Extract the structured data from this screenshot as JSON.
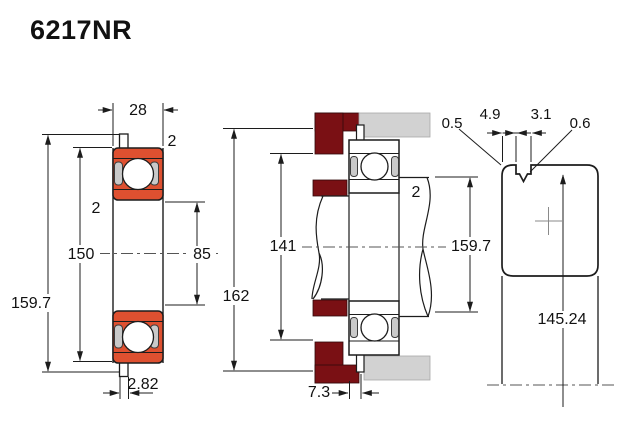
{
  "title": "6217NR",
  "front_view": {
    "width": "28",
    "outer_diameter": "150",
    "bore_diameter": "85",
    "snap_ring_od": "159.7",
    "chamfer_outer": "2",
    "chamfer_inner": "2",
    "snap_ring_thickness": "2.82"
  },
  "mounted_view": {
    "housing_bore": "162",
    "housing_shoulder": "141",
    "shaft_chamfer": "2",
    "abutment_diameter": "159.7",
    "snap_ring_offset": "7.3"
  },
  "groove_view": {
    "corner_radius": "0.5",
    "groove_offset": "4.9",
    "groove_width": "3.1",
    "groove_edge_radius": "0.6",
    "groove_diameter": "145.24"
  },
  "colors": {
    "bearing_fill": "#de5030",
    "housing_fill": "#7a1014",
    "block_gray": "#d2d2d2",
    "raceway_gray": "#c9c9c9",
    "line": "#1c1c1c"
  }
}
